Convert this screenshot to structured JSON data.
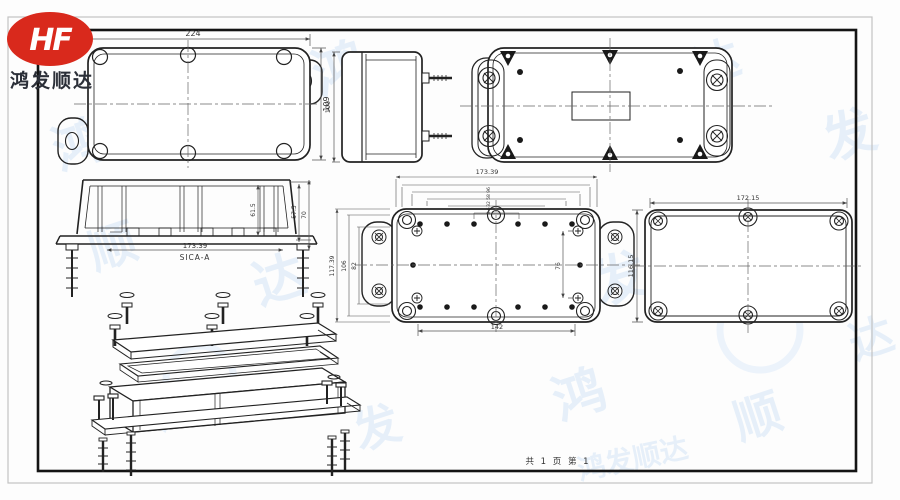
{
  "logo": {
    "monogram": "HF",
    "company": "鸿发顺达",
    "brand_color": "#d9291c"
  },
  "watermark": {
    "text": "鸿发顺达",
    "chars": [
      "鸿",
      "发",
      "顺",
      "达"
    ],
    "color": "#dbe9f7"
  },
  "footer": {
    "page_info": "共 1 页  第 1"
  },
  "views": {
    "top_view": {
      "dims": {
        "width": "224",
        "height": "109"
      }
    },
    "side_view": {
      "dims": {
        "height": "109"
      }
    },
    "section_view": {
      "label": "SICA-A",
      "dims": {
        "width": "173.39",
        "inner_height": "61.5",
        "mid_height": "57.5",
        "total_height": "70"
      }
    },
    "holes_view": {
      "dims": {
        "top_width": "173.39",
        "left_outer": "117.39",
        "left_mid": "106",
        "left_inner": "82",
        "bottom": "142",
        "right_inner": "76",
        "stack": [
          "96",
          "58",
          "32",
          "8.6"
        ]
      }
    },
    "lid_view": {
      "dims": {
        "width": "172.15",
        "height": "116.15"
      }
    }
  }
}
